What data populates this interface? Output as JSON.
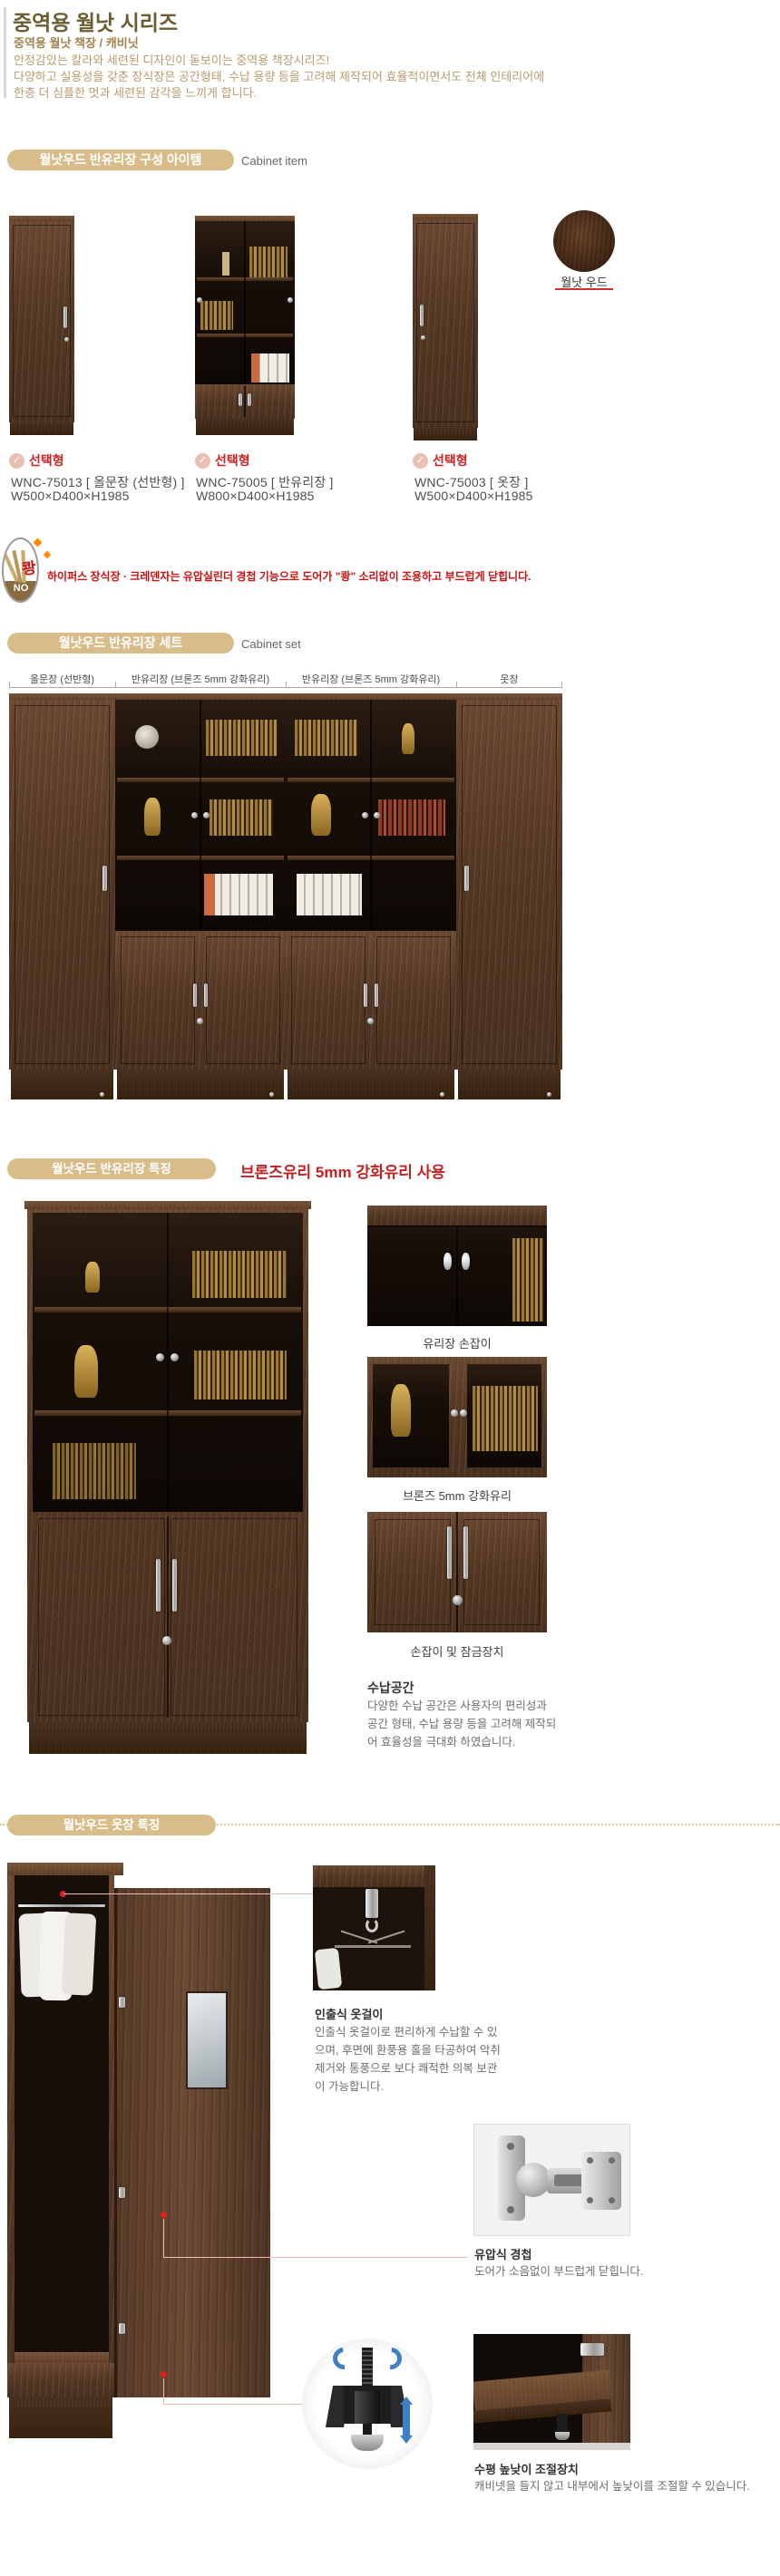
{
  "header": {
    "title": "중역용 월낫 시리즈",
    "subtitle": "중역용 월낫 책장 / 캐비닛",
    "desc1": "안정감있는 칼라와 세련된 디자인이 돋보이는 중역용 책장시리즈!",
    "desc2": "다양하고 실용성을 갖춘 장식장은 공간형태, 수납 용량 등을 고려해 제작되어 효율적이면서도 전체 인테리어에",
    "desc3": "한층 더 심플한 멋과 세련된 감각을 느끼게 합니다."
  },
  "section_item": {
    "title": "월낫우드 반유리장 구성 아이템",
    "subtitle": "Cabinet item",
    "badge_check": "✓",
    "badge": "선택형",
    "products": [
      {
        "label": "WNC-75013  [ 올문장 (선반형) ]",
        "size": "W500×D400×H1985"
      },
      {
        "label": "WNC-75005  [ 반유리장 ]",
        "size": "W800×D400×H1985"
      },
      {
        "label": "WNC-75003  [ 옷장 ]",
        "size": "W500×D400×H1985"
      }
    ],
    "swatch_label": "월낫 우드"
  },
  "notice": {
    "kwang": "쾅",
    "no": "NO",
    "text": "하이퍼스 장식장 · 크레덴자는 유압실린더 경첩 기능으로 도어가 \"쾅\" 소리없이 조용하고 부드럽게 닫힙니다."
  },
  "section_set": {
    "title": "월낫우드 반유리장 세트",
    "subtitle": "Cabinet set",
    "columns": [
      "올문장 (선반형)",
      "반유리장 (브론즈 5mm 강화유리)",
      "반유리장 (브론즈 5mm 강화유리)",
      "옷장"
    ]
  },
  "section_feature": {
    "title": "월낫우드 반유리장 특징",
    "highlight": "브론즈유리 5mm 강화유리 사용",
    "caption1": "유리장 손잡이",
    "caption2": "브론즈 5mm 강화유리",
    "caption3": "손잡이 및 잠금장치",
    "storage_title": "수납공간",
    "storage_body": "다양한 수납 공간은 사용자의 편리성과 공간 형태, 수납 용량 등을 고려해 제작되어 효율성을 극대화 하였습니다."
  },
  "section_wardrobe": {
    "title": "월낫우드 옷장 특징",
    "f1_title": "인출식 옷걸이",
    "f1_body": "인출식 옷걸이로 편리하게 수납할 수 있으며, 후면에 환풍용 홀을 타공하여 악취제거와 통풍으로 보다 쾌적한 의복 보관이 가능합니다.",
    "f2_title": "유압식 경첩",
    "f2_body": "도어가 소음없이 부드럽게 닫힙니다.",
    "f3_title": "수평 높낮이 조절장치",
    "f3_body": "캐비넷을 들지 않고 내부에서 높낮이를 조절할 수 있습니다."
  }
}
